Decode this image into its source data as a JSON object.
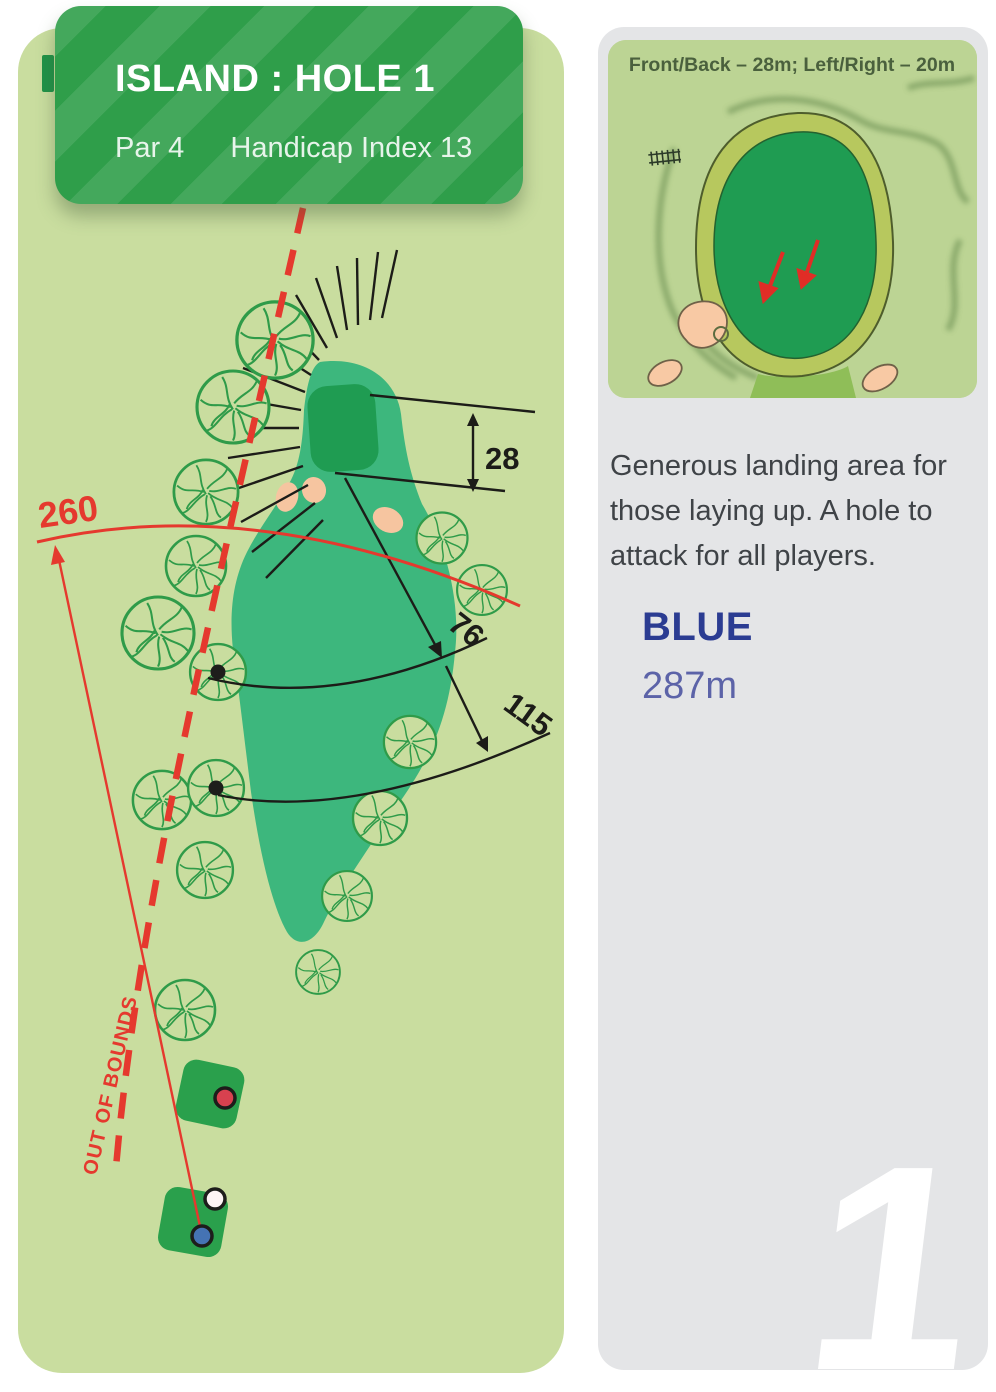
{
  "header": {
    "title": "ISLAND : HOLE 1",
    "par": "Par 4",
    "handicap": "Handicap Index 13"
  },
  "map": {
    "driving_distance_label": "260",
    "green_depth_label": "28",
    "distance_marker_1": "76",
    "distance_marker_2": "115",
    "out_of_bounds_label": "OUT OF BOUNDS"
  },
  "green_detail": {
    "title": "Front/Back – 28m; Left/Right – 20m"
  },
  "sidebar": {
    "description": "Generous landing area for those laying up. A hole to attack for all players.",
    "tee": {
      "name": "BLUE",
      "distance": "287m"
    },
    "hole_number": "1"
  },
  "colors": {
    "card_green": "#2f9e4a",
    "map_background": "#c9dd9f",
    "fairway_green": "#3db77d",
    "putting_green": "#1f9c52",
    "bunker_sand": "#f6c5a0",
    "accent_red": "#e5392e",
    "tee_name_blue": "#2b3c92",
    "sidebar_gray": "#e4e5e7"
  }
}
